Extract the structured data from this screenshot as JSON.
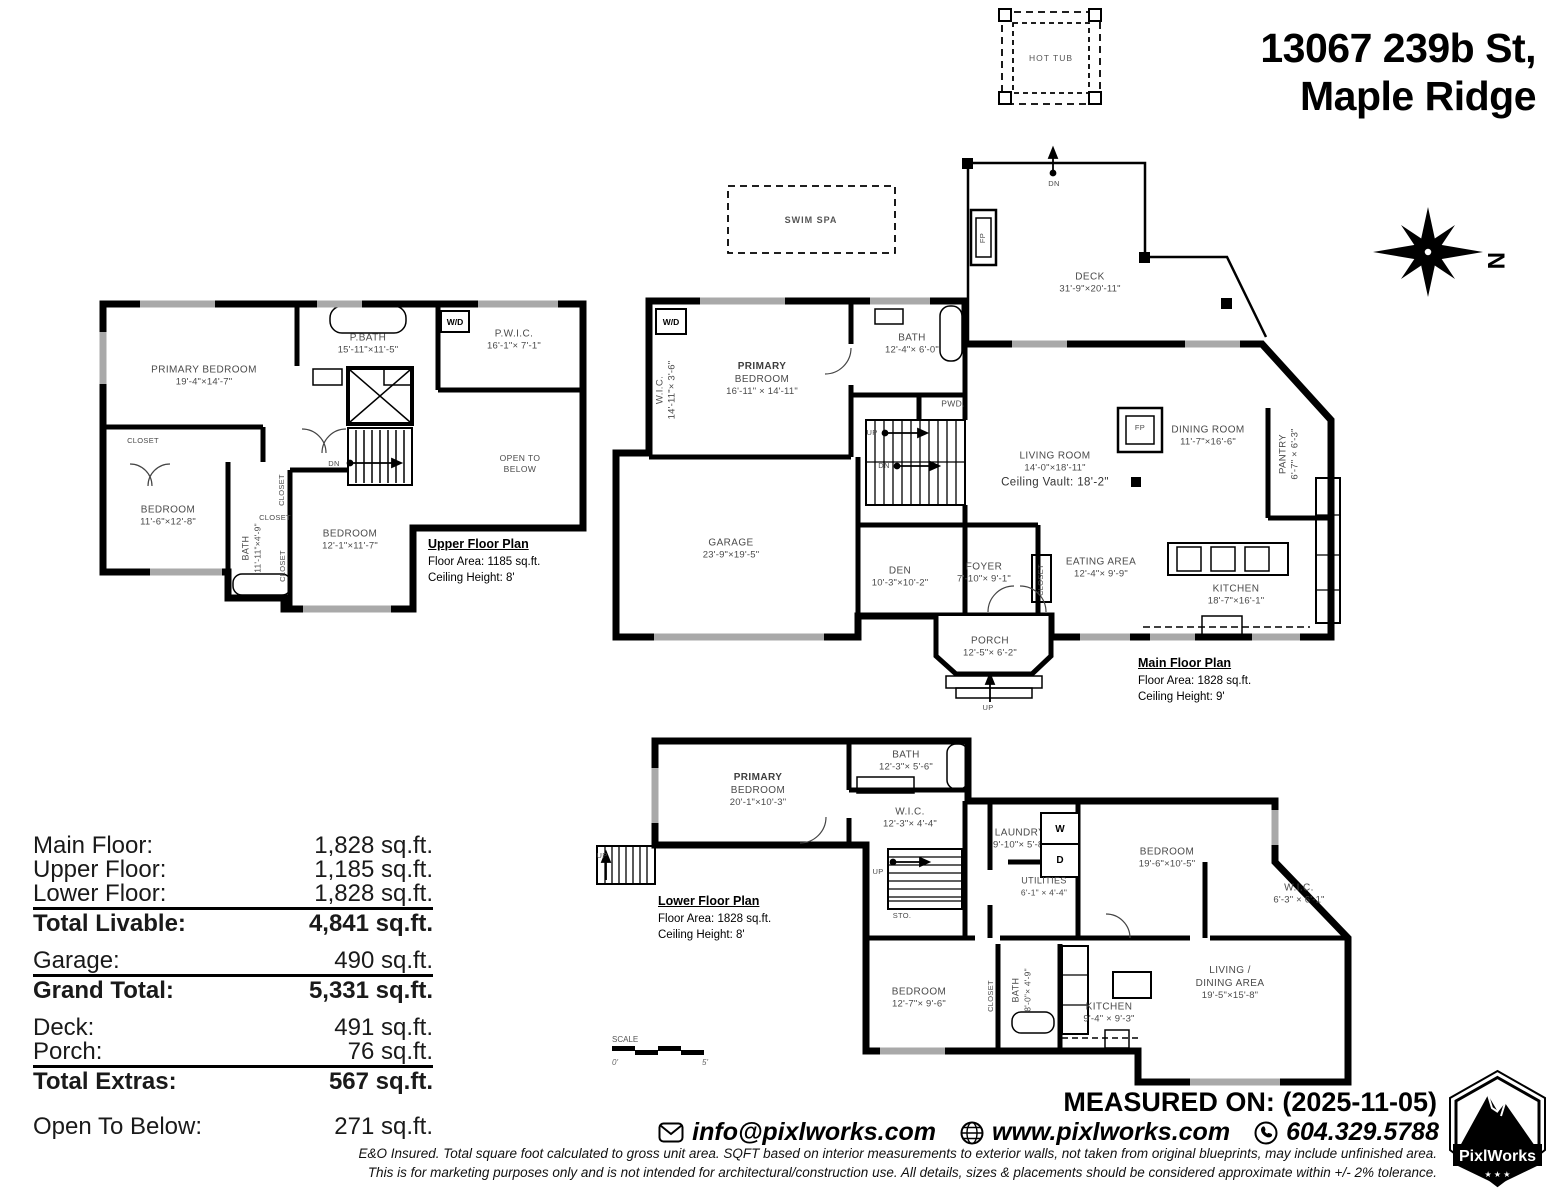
{
  "title": {
    "line1": "13067 239b St,",
    "line2": "Maple Ridge"
  },
  "site": {
    "hot_tub": "HOT TUB",
    "swim_spa": "SWIM SPA",
    "north": "N",
    "scale_label": "SCALE",
    "scale_start": "0'",
    "scale_end": "5'"
  },
  "floors": {
    "upper": {
      "plan_title": "Upper Floor Plan",
      "floor_area": "Floor Area: 1185 sq.ft.",
      "ceiling_height": "Ceiling Height: 8'",
      "rooms": {
        "primary_bedroom": {
          "name": "PRIMARY BEDROOM",
          "dims": "19'-4\"×14'-7\""
        },
        "p_bath": {
          "name": "P.BATH",
          "dims": "15'-11\"×11'-5\""
        },
        "pwic": {
          "name": "P.W.I.C.",
          "dims": "16'-1\"× 7'-1\""
        },
        "wd": "W/D",
        "closet_left": "CLOSET",
        "bedroom1": {
          "name": "BEDROOM",
          "dims": "11'-6\"×12'-8\""
        },
        "bath": {
          "name": "BATH",
          "dims": "11'-11\"×4'-9\""
        },
        "closet_a": "CLOSET",
        "closet_b": "CLOSET",
        "closet_c": "CLOSET",
        "bedroom2": {
          "name": "BEDROOM",
          "dims": "12'-1\"×11'-7\""
        },
        "open_below": {
          "line1": "OPEN TO",
          "line2": "BELOW"
        },
        "dn": "DN"
      }
    },
    "main": {
      "plan_title": "Main Floor Plan",
      "floor_area": "Floor Area: 1828 sq.ft.",
      "ceiling_height": "Ceiling Height: 9'",
      "rooms": {
        "wd": "W/D",
        "wic": {
          "name": "W.I.C.",
          "dims": "14'-11\"× 3'-6\""
        },
        "primary_bedroom": {
          "prefix": "PRIMARY",
          "name": "BEDROOM",
          "dims": "16'-11\" × 14'-11\""
        },
        "bath": {
          "name": "BATH",
          "dims": "12'-4\"× 6'-0\""
        },
        "pwd": "PWD.",
        "living": {
          "name": "LIVING ROOM",
          "dims": "14'-0\"×18'-11\"",
          "extra": "Ceiling Vault: 18'-2\""
        },
        "dining": {
          "name": "DINING ROOM",
          "dims": "11'-7\"×16'-6\""
        },
        "pantry": {
          "name": "PANTRY",
          "dims": "6'-7\" × 6'-3\""
        },
        "deck": {
          "name": "DECK",
          "dims": "31'-9\"×20'-11\""
        },
        "fp_deck": "FP",
        "fp_living": "FP",
        "garage": {
          "name": "GARAGE",
          "dims": "23'-9\"×19'-5\""
        },
        "den": {
          "name": "DEN",
          "dims": "10'-3\"×10'-2\""
        },
        "foyer": {
          "name": "FOYER",
          "dims": "7'-10\"× 9'-1\""
        },
        "closet": "CLOSET",
        "eating": {
          "name": "EATING AREA",
          "dims": "12'-4\"× 9'-9\""
        },
        "kitchen": {
          "name": "KITCHEN",
          "dims": "18'-7\"×16'-1\""
        },
        "porch": {
          "name": "PORCH",
          "dims": "12'-5\"× 6'-2\""
        },
        "up": "UP",
        "dn": "DN",
        "dn_deck": "DN",
        "up_porch": "UP"
      }
    },
    "lower": {
      "plan_title": "Lower Floor Plan",
      "floor_area": "Floor Area: 1828 sq.ft.",
      "ceiling_height": "Ceiling Height: 8'",
      "rooms": {
        "primary_bedroom": {
          "prefix": "PRIMARY",
          "name": "BEDROOM",
          "dims": "20'-1\"×10'-3\""
        },
        "bath1": {
          "name": "BATH",
          "dims": "12'-3\"× 5'-6\""
        },
        "wic1": {
          "name": "W.I.C.",
          "dims": "12'-3\"× 4'-4\""
        },
        "laundry": {
          "name": "LAUNDRY",
          "dims": "9'-10\"× 5'-8\""
        },
        "washer": "W",
        "dryer": "D",
        "utilities": {
          "name": "UTILITIES",
          "dims": "6'-1\" × 4'-4\""
        },
        "storage": "STO.",
        "bedroom1": {
          "name": "BEDROOM",
          "dims": "19'-6\"×10'-5\""
        },
        "wic2": {
          "name": "W.I.C.",
          "dims": "6'-3\" × 6'-1\""
        },
        "bedroom2": {
          "name": "BEDROOM",
          "dims": "12'-7\"× 9'-6\""
        },
        "closet": "CLOSET",
        "bath2": {
          "name": "BATH",
          "dims": "8'-0\"× 4'-9\""
        },
        "kitchen": {
          "name": "KITCHEN",
          "dims": "9'-4\" × 9'-3\""
        },
        "living_dining": {
          "name": "LIVING /",
          "name2": "DINING AREA",
          "dims": "19'-5\"×15'-8\""
        },
        "up1": "UP",
        "up2": "UP"
      }
    }
  },
  "stats": {
    "group1": {
      "rows": [
        {
          "label": "Main Floor:",
          "value": "1,828 sq.ft."
        },
        {
          "label": "Upper Floor:",
          "value": "1,185 sq.ft."
        },
        {
          "label": "Lower Floor:",
          "value": "1,828 sq.ft."
        }
      ],
      "total": {
        "label": "Total Livable:",
        "value": "4,841 sq.ft."
      }
    },
    "group2": {
      "rows": [
        {
          "label": "Garage:",
          "value": "490 sq.ft."
        }
      ],
      "total": {
        "label": "Grand Total:",
        "value": "5,331 sq.ft."
      }
    },
    "group3": {
      "rows": [
        {
          "label": "Deck:",
          "value": "491 sq.ft."
        },
        {
          "label": "Porch:",
          "value": "76 sq.ft."
        }
      ],
      "total": {
        "label": "Total Extras:",
        "value": "567 sq.ft."
      }
    },
    "group4": {
      "rows": [
        {
          "label": "Open To Below:",
          "value": "271 sq.ft."
        }
      ]
    }
  },
  "footer": {
    "measured_on": "MEASURED ON: (2025-11-05)",
    "email": "info@pixlworks.com",
    "website": "www.pixlworks.com",
    "phone": "604.329.5788",
    "disclaimer1": "E&O Insured.  Total square foot calculated to gross unit area. SQFT based on interior measurements to exterior walls, not taken from original blueprints, may include unfinished area.",
    "disclaimer2": "This is for marketing purposes only and is not intended for architectural/construction use.  All details, sizes & placements should be considered approximate within +/- 2%  tolerance.",
    "brand": "PixlWorks",
    "stars": "★ ★ ★"
  }
}
